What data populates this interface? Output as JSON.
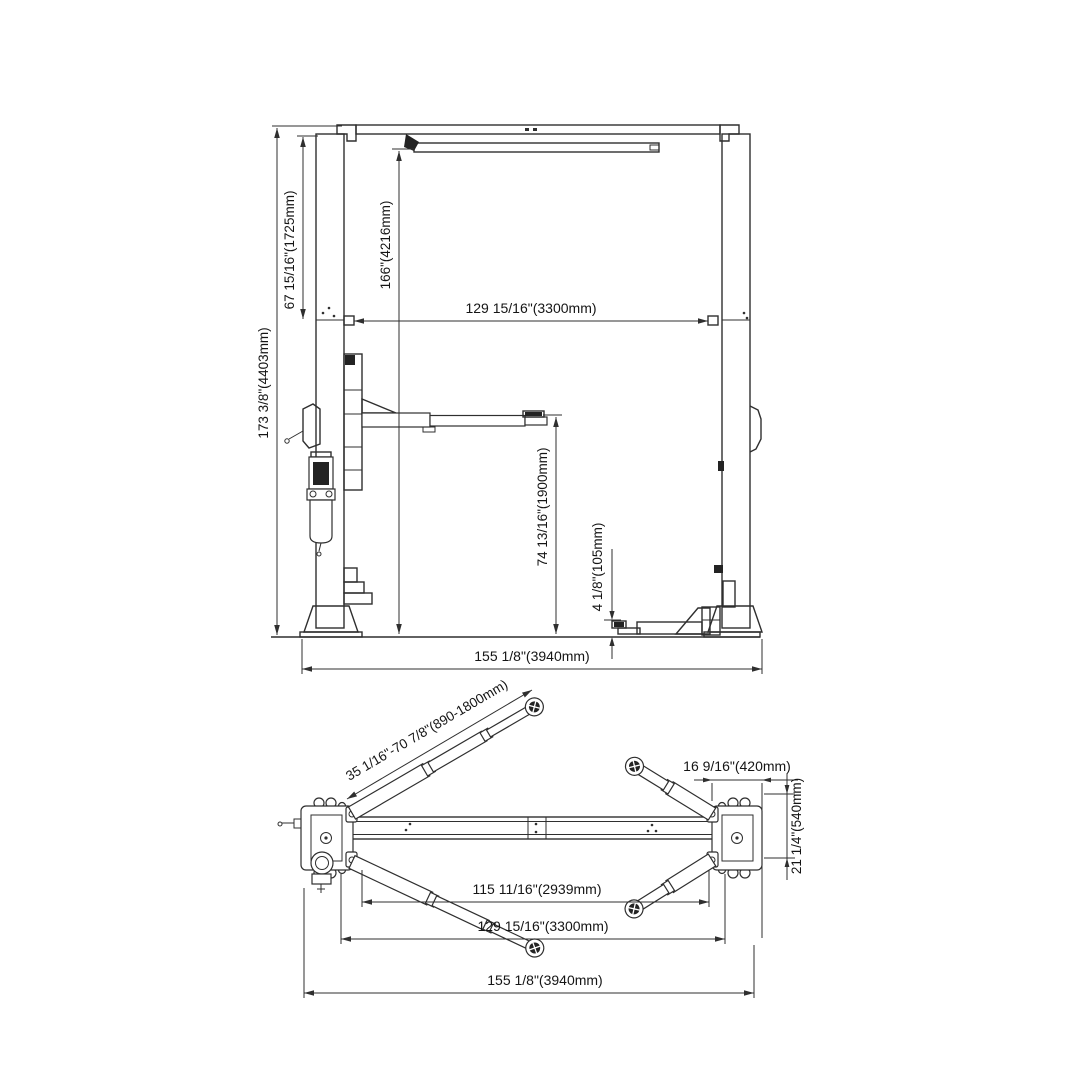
{
  "page": {
    "background": "#ffffff",
    "line_color": "#2f2f2f",
    "text_color": "#151515",
    "subject": "two-post vehicle lift dimensional drawing"
  },
  "front_view": {
    "dimensions": {
      "overall_height": "173 3/8\"(4403mm)",
      "upper_section_height": "67 15/16\"(1725mm)",
      "clearance_under_beam": "166\"(4216mm)",
      "between_posts": "129 15/16\"(3300mm)",
      "max_lifting_height": "74 13/16\"(1900mm)",
      "min_pad_height": "4 1/8\"(105mm)",
      "overall_width": "155 1/8\"(3940mm)"
    }
  },
  "plan_view": {
    "dimensions": {
      "arm_reach_range": "35 1/16\"-70 7/8\"(890-1800mm)",
      "baseplate_width": "16 9/16\"(420mm)",
      "baseplate_depth": "21 1/4\"(540mm)",
      "inside_clearance": "115 11/16\"(2939mm)",
      "between_posts": "129 15/16\"(3300mm)",
      "overall_width": "155 1/8\"(3940mm)"
    }
  }
}
